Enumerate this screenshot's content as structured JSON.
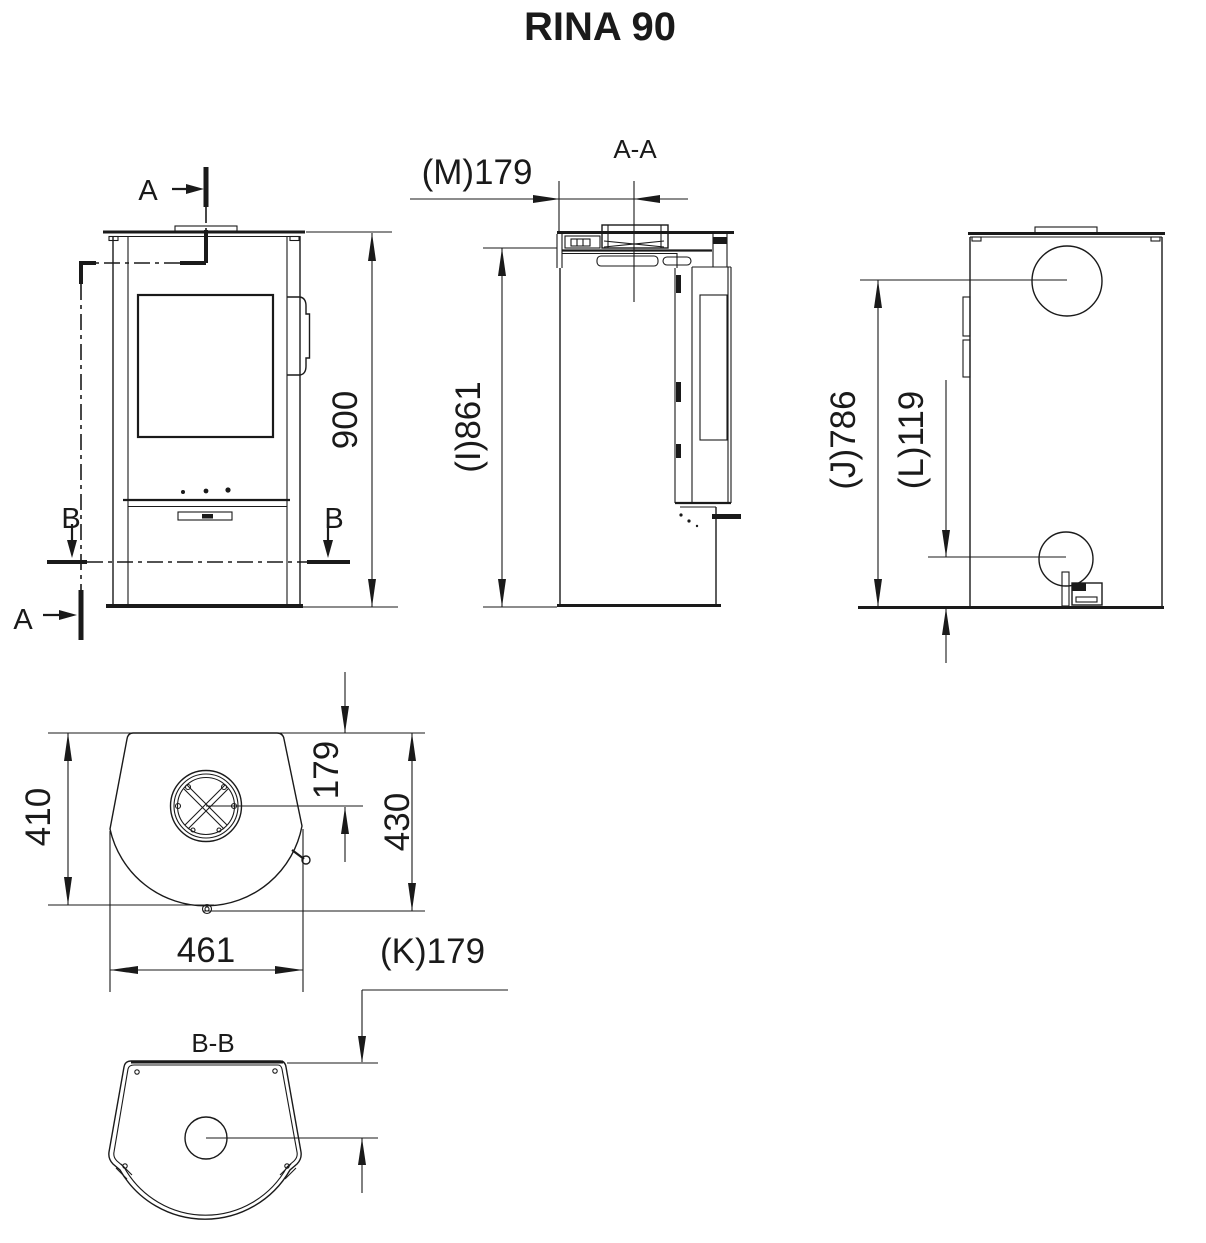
{
  "title": "RINA 90",
  "colors": {
    "ink": "#1a1a1a",
    "background": "#ffffff"
  },
  "views": {
    "front": {
      "name": "front-view",
      "height": "900",
      "section_a_top": "A",
      "section_a_bottom": "A",
      "section_b_left": "B",
      "section_b_right": "B"
    },
    "side_section": {
      "name": "section-a-a",
      "label": "A-A",
      "flue_offset_from_back": "(M)179",
      "height_under_top": "(I)861"
    },
    "back": {
      "name": "back-view",
      "flue_center_height": "(J)786",
      "intake_center_height": "(L)119"
    },
    "top": {
      "name": "top-view",
      "depth_to_rear_curve": "410",
      "flue_center_offset": "179",
      "depth_total": "430",
      "width": "461"
    },
    "section_bb": {
      "name": "section-b-b",
      "label": "B-B",
      "intake_center_offset": "(K)179"
    }
  }
}
